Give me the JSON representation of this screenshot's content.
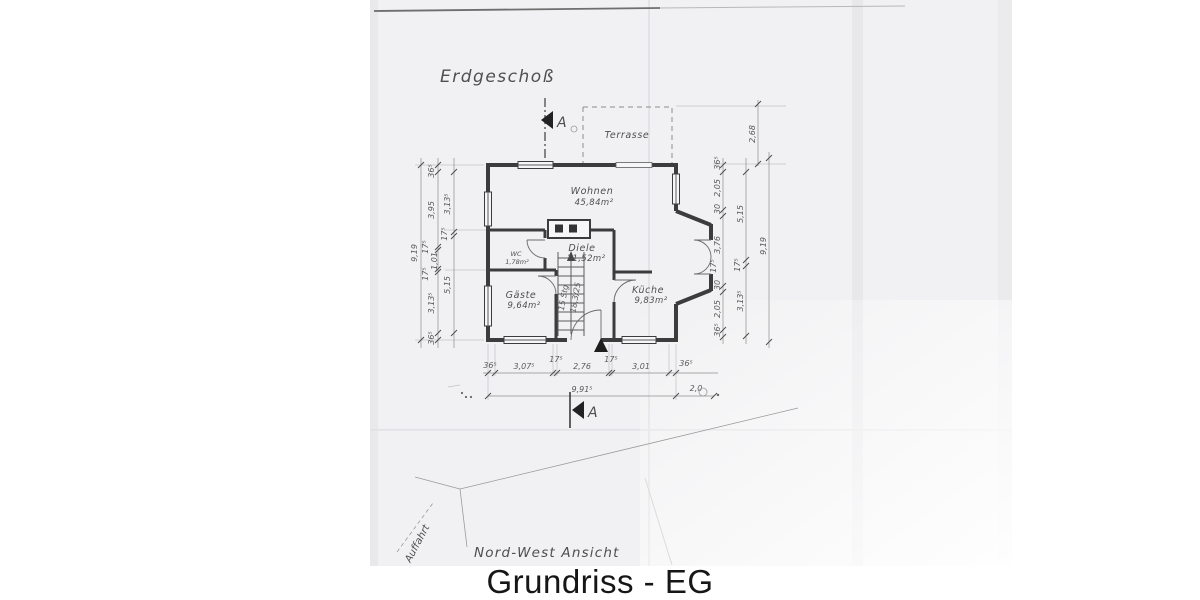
{
  "caption": "Grundriss - EG",
  "titles": {
    "floor": "Erdgeschoß",
    "view": "Nord-West Ansicht",
    "driveway": "Auffahrt",
    "section": "A"
  },
  "rooms": {
    "terrasse": {
      "name": "Terrasse"
    },
    "wohnen": {
      "name": "Wohnen",
      "area": "45,84m²"
    },
    "diele": {
      "name": "Diele",
      "area": "11,52m²"
    },
    "wc": {
      "name": "WC",
      "area": "1,78m²"
    },
    "gaeste": {
      "name": "Gäste",
      "area": "9,64m²"
    },
    "kueche": {
      "name": "Küche",
      "area": "9,83m²"
    }
  },
  "stairs": {
    "line1": "15 Stg",
    "line2": "18,3/25"
  },
  "dims": {
    "left_outer": "9,19",
    "left_mid": [
      "36⁵",
      "3,95",
      "17⁵",
      "1,01",
      "17⁵",
      "3,13⁵",
      "36⁵"
    ],
    "left_inner": [
      "3,13⁵",
      "17⁵",
      "5,15"
    ],
    "right_inner": [
      "36⁵",
      "2,05",
      "30",
      "3,76",
      "17⁵",
      "30",
      "2,05",
      "36⁵"
    ],
    "right_mid": [
      "5,15",
      "17⁵",
      "3,13⁵"
    ],
    "right_outer": "9,19",
    "terrace_depth": "2,68",
    "bottom": [
      "36⁵",
      "3,07⁵",
      "17⁵",
      "2,76",
      "17⁵",
      "3,01",
      "36⁵"
    ],
    "bottom_total": "9,91⁵",
    "bottom_right": "2,0"
  },
  "colors": {
    "paper": "#f1f1f3",
    "ink": "#3c3c3c",
    "pencil": "#5a5a5a"
  }
}
